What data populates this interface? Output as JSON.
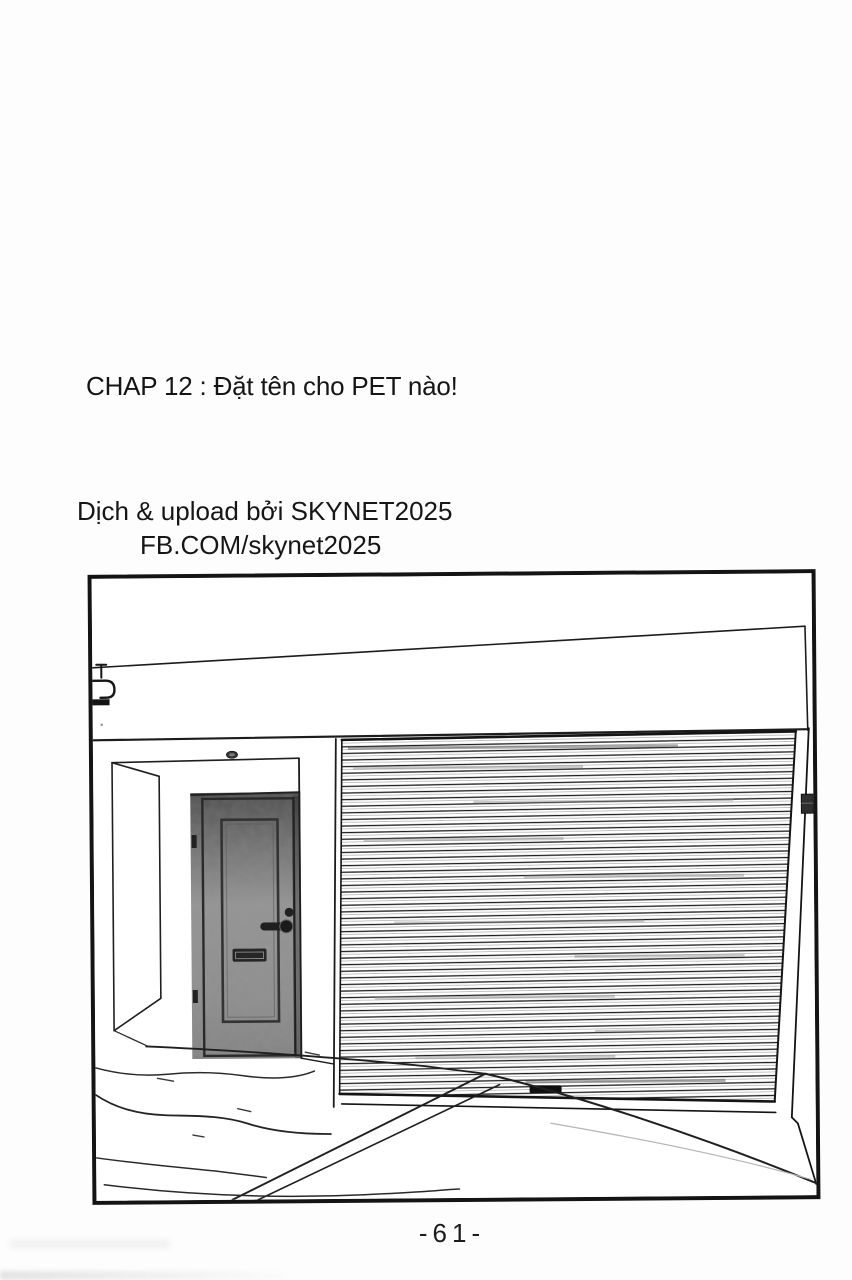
{
  "page": {
    "chapter_title": "CHAP 12 : Đặt tên cho PET nào!",
    "credit_line_1": "Dịch & upload bởi SKYNET2025",
    "credit_line_2": "FB.COM/skynet2025",
    "page_number": "-61-",
    "background_color": "#fdfdfd",
    "ink_color": "#161616"
  },
  "panel": {
    "alt": "Manga panel: shop exterior with a closed corrugated roller shutter on the right, a recessed metal entry door with lever handle and mail slot on the left, blank signboard above, concrete step and walkway in the foreground",
    "colors": {
      "door_top": "#4e4e4e",
      "door_mid": "#949494",
      "door_bottom": "#838383",
      "slat_line": "#1d1d1d"
    }
  }
}
